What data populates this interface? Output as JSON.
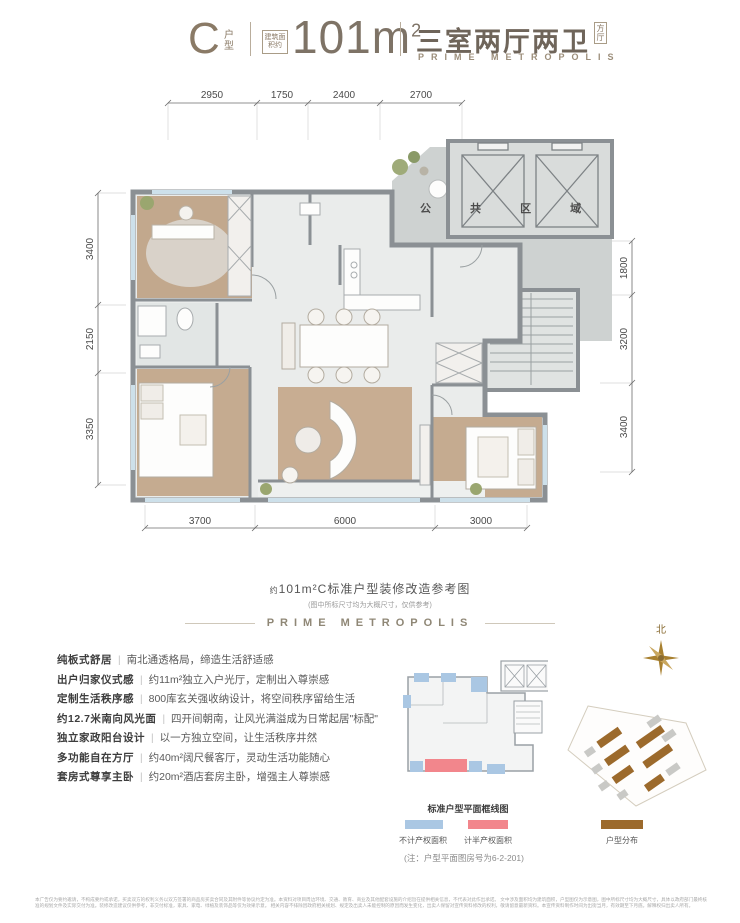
{
  "header": {
    "unit_letter": "C",
    "unit_label": "户型",
    "area_badge": "建筑面积约",
    "area_value": "101m",
    "area_sup": "2",
    "layout_title": "三室两厅两卫",
    "layout_tag": "方厅",
    "brand": "PRIME METROPOLIS"
  },
  "floorplan": {
    "public_area_label": "公 共 区 域",
    "dims_top": [
      "2950",
      "1750",
      "2400",
      "2700"
    ],
    "dims_bottom": [
      "3700",
      "6000",
      "3000"
    ],
    "dims_left": [
      "3400",
      "2150",
      "3350"
    ],
    "dims_right": [
      "1800",
      "3200",
      "3400"
    ]
  },
  "caption": {
    "prefix": "约",
    "title": "101m²C标准户型装修改造参考图",
    "subtitle": "(图中所标尺寸均为大概尺寸，仅供参考)",
    "brand": "PRIME METROPOLIS"
  },
  "features": [
    {
      "label": "纯板式舒居",
      "desc": "南北通透格局，缔造生活舒适感"
    },
    {
      "label": "出户归家仪式感",
      "desc": "约11m²独立入户光厅，定制出入尊崇感"
    },
    {
      "label": "定制生活秩序感",
      "desc": "800库玄关强收纳设计，将空间秩序留给生活"
    },
    {
      "label": "约12.7米南向风光面",
      "desc": "四开间朝南，让风光满溢成为日常起居\"标配\""
    },
    {
      "label": "独立家政阳台设计",
      "desc": "以一方独立空间，让生活秩序井然"
    },
    {
      "label": "多功能自在方厅",
      "desc": "约40m²阔尺餐客厅，灵动生活功能随心"
    },
    {
      "label": "套房式尊享主卧",
      "desc": "约20m²酒店套房主卧，增强主人尊崇感"
    }
  ],
  "mini_map": {
    "title": "标准户型平面框线图"
  },
  "legend": [
    {
      "label": "不计产权面积",
      "color": "#aac7e3"
    },
    {
      "label": "计半产权面积",
      "color": "#f2868c"
    },
    {
      "label": "户型分布",
      "color": "#9c6a2c"
    }
  ],
  "note": "(注：户型平面图房号为6-2-201)",
  "compass": {
    "label": "北"
  },
  "disclaimer": [
    "本广告仅为要约邀请，不构成要约或承诺，买卖双方的权利义务以双方签署的商品房买卖合同及其附件等协议约定为准。本资料对项目周边环境、交通、教育、商业及其他配套设施的介绍旨在提供相关信息，不代表对此作出承诺。",
    "文中涉及面积均为建筑面积，户型图仅为示意图，图中所标尺寸均为大概尺寸，具体以政府部门最终核准的规划文件及实际交付为准。装修改造建议仅供参考，非交付标准，家具、家电、绿植及装饰品等仅为效果示意。",
    "相关内容不排除因政府相关规划、规定及出卖人未能控制的原因而发生变化，出卖人保留对宣传资料修改的权利，敬请留意最新资料。本宣传资料制作时间为出街当月，有效期至下月底。解释权归出卖人所有。"
  ],
  "colors": {
    "accent_gold": "#8a7a66",
    "wall_gray": "#8b9094",
    "wood": "#c2a88d",
    "floor": "#eaeceb",
    "public_gray": "#ced2d1",
    "window_blue": "#cde0ea",
    "legend_blue": "#aac7e3",
    "legend_red": "#f2868c",
    "legend_brown": "#9c6a2c",
    "compass_gold": "#a8802f"
  }
}
